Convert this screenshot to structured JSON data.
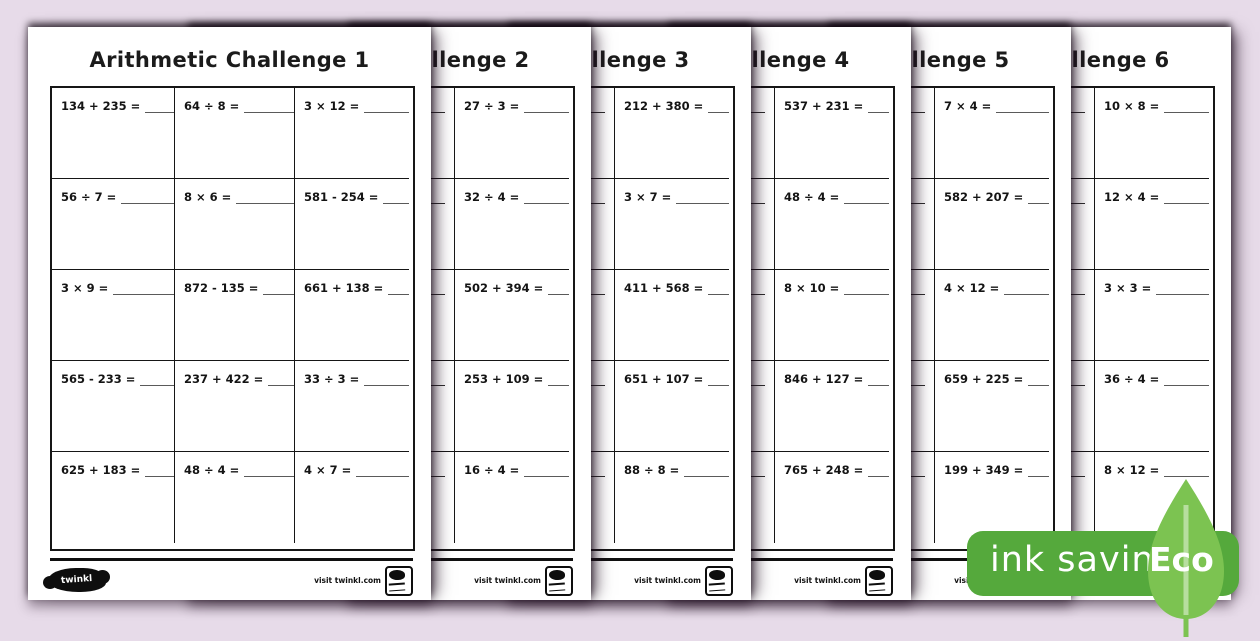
{
  "background_color": "#e7dbe9",
  "footer": {
    "logo_text": "twinkl",
    "visit_text": "visit twinkl.com"
  },
  "badge": {
    "label": "ink saving",
    "eco_label": "Eco",
    "badge_color": "#55a93c",
    "leaf_color": "#7cc351"
  },
  "pages": [
    {
      "title": "Arithmetic Challenge 1",
      "problems": [
        "134 + 235 =",
        "64 ÷ 8 =",
        "3 × 12 =",
        "56 ÷ 7 =",
        "8 × 6 =",
        "581 - 254 =",
        "3 × 9 =",
        "872 - 135 =",
        "661 + 138 =",
        "565 - 233 =",
        "237 + 422 =",
        "33 ÷ 3 =",
        "625 + 183 =",
        "48 ÷ 4 =",
        "4 × 7 ="
      ]
    },
    {
      "title": "Arithmetic Challenge 2",
      "problems": [
        "",
        "",
        "27 ÷ 3 =",
        "",
        "",
        "32 ÷ 4 =",
        "",
        "",
        "502 + 394 =",
        "",
        "",
        "253 + 109 =",
        "",
        "",
        "16 ÷ 4 ="
      ]
    },
    {
      "title": "Arithmetic Challenge 3",
      "problems": [
        "",
        "",
        "212 + 380 =",
        "",
        "",
        "3 × 7 =",
        "",
        "",
        "411 + 568 =",
        "",
        "",
        "651 + 107 =",
        "",
        "",
        "88 ÷ 8 ="
      ]
    },
    {
      "title": "Arithmetic Challenge 4",
      "problems": [
        "",
        "",
        "537 + 231 =",
        "",
        "",
        "48 ÷ 4 =",
        "",
        "",
        "8 × 10 =",
        "",
        "",
        "846 + 127 =",
        "",
        "",
        "765 + 248 ="
      ]
    },
    {
      "title": "Arithmetic Challenge 5",
      "problems": [
        "",
        "",
        "7 × 4 =",
        "",
        "",
        "582 + 207 =",
        "",
        "",
        "4 × 12 =",
        "",
        "",
        "659 + 225 =",
        "",
        "",
        "199 + 349 ="
      ]
    },
    {
      "title": "Arithmetic Challenge 6",
      "problems": [
        "",
        "",
        "10 × 8 =",
        "",
        "",
        "12 × 4 =",
        "",
        "",
        "3 × 3 =",
        "",
        "",
        "36 ÷ 4 =",
        "",
        "",
        "8 × 12 ="
      ]
    }
  ]
}
